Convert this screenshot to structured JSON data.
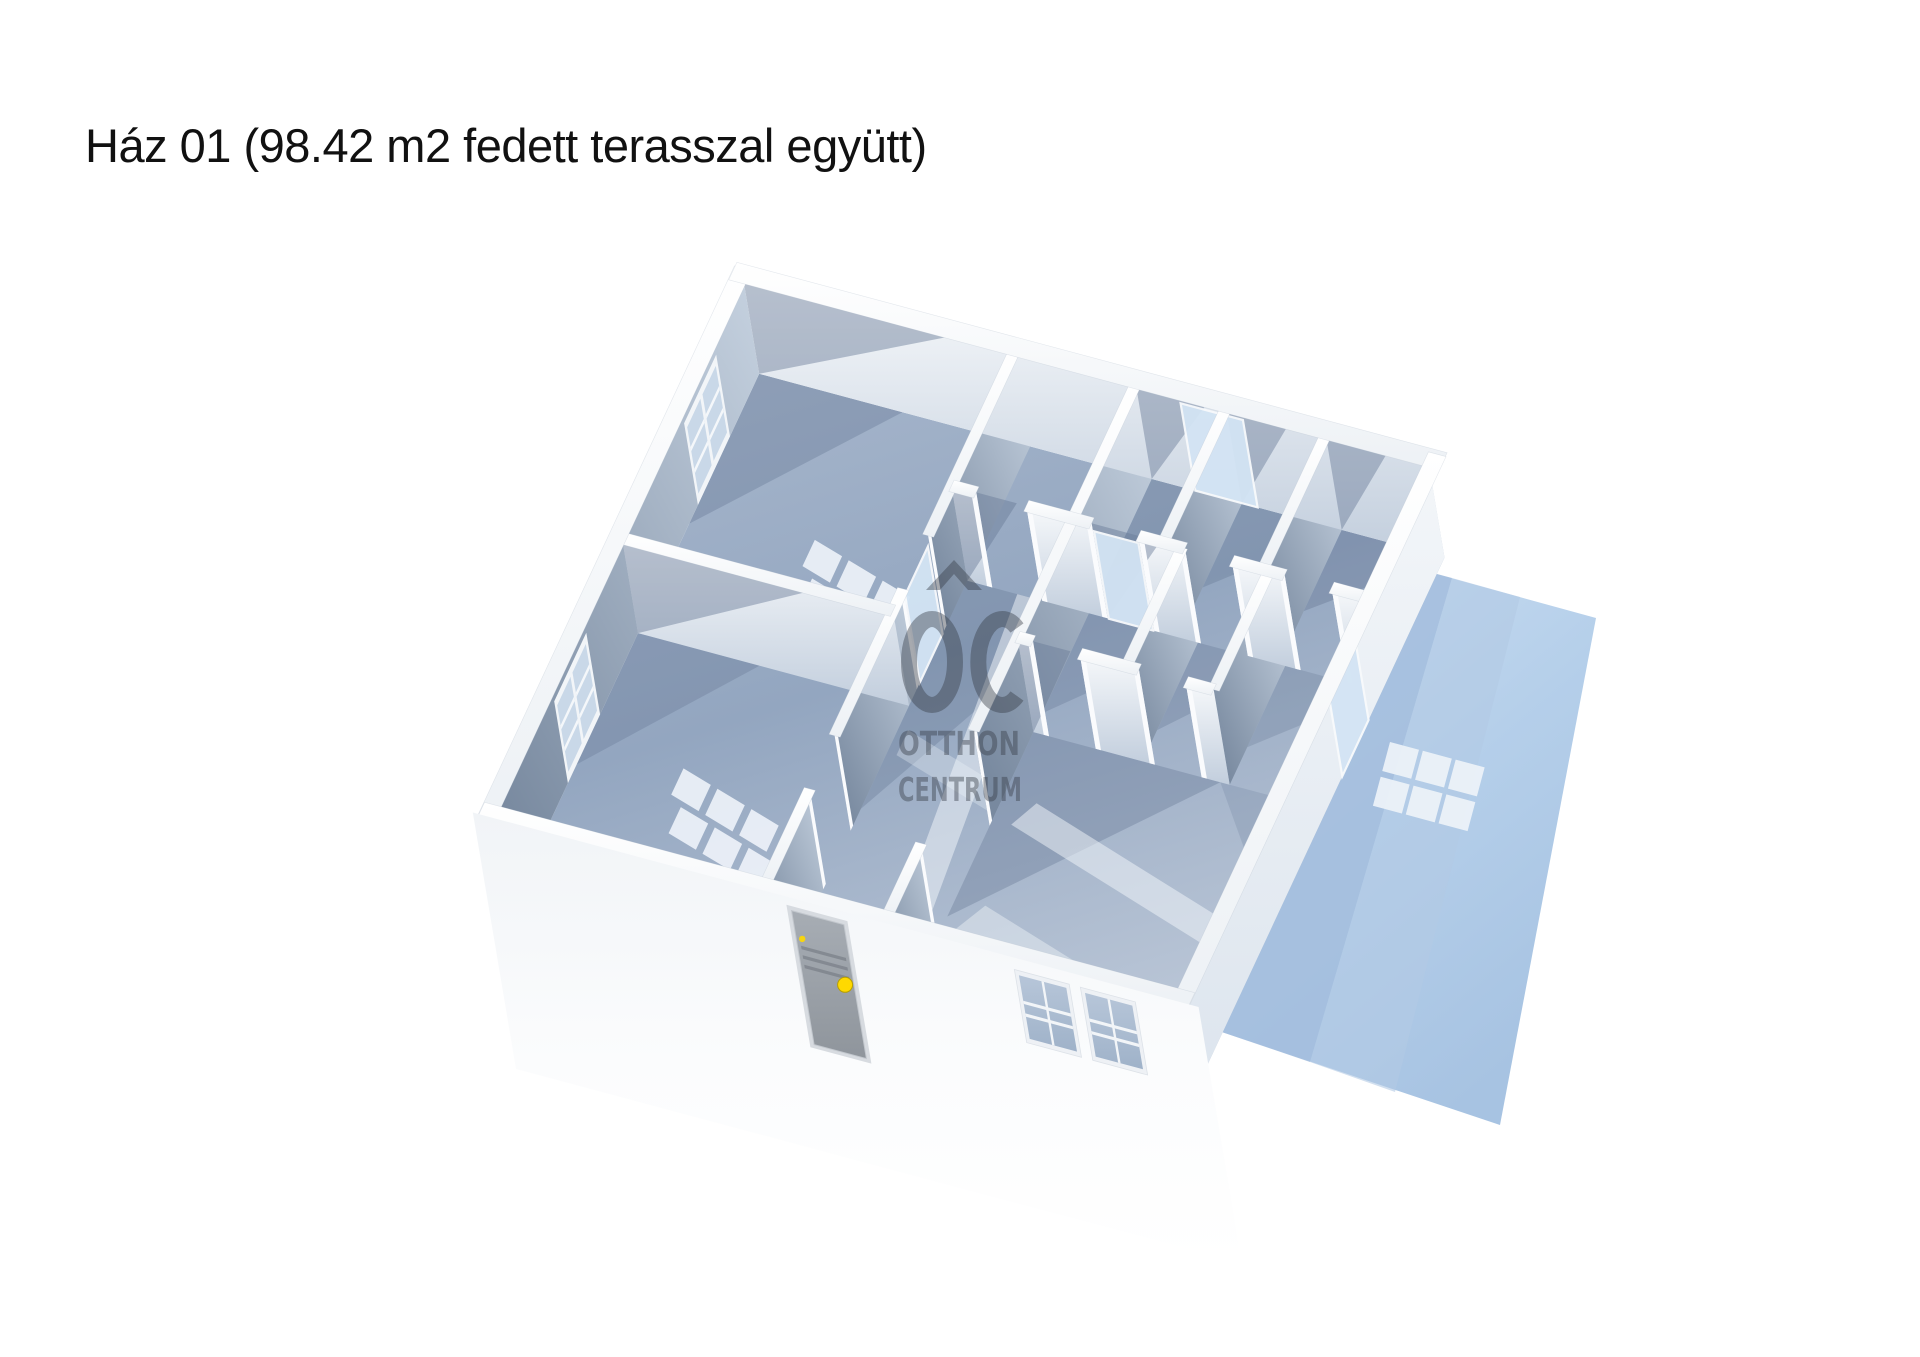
{
  "title": {
    "text": "Ház 01 (98.42 m2 fedett terasszal együtt)"
  },
  "watermark": {
    "monogram": "OC",
    "line1": "OTTHON",
    "line2": "CENTRUM"
  },
  "colors": {
    "background": "#ffffff",
    "title_text": "#111111",
    "watermark": "#363c46",
    "floor_dark": "#8da1bd",
    "floor_light": "#b9c5d6",
    "wall_top": "#fdfdfe",
    "wall_lit_top": "#f7f9fb",
    "wall_lit_bottom": "#c2cedd",
    "wall_shadow_top": "#c6d2e0",
    "wall_shadow_bottom": "#78899f",
    "terrace_light": "#cfe1f3",
    "terrace_mid": "#aac6e4",
    "terrace_shadow": "#a3bddd",
    "glass": "#c9d8e8",
    "glazed_door": "#d3e4f4",
    "door_slab": "#9aa0a8",
    "door_knob": "#ffd900",
    "light_patch": "#eef3f9"
  },
  "floorplan": {
    "origin": [
      495,
      810
    ],
    "U": [
      62.3,
      16.7
    ],
    "V": [
      29.2,
      -62.5
    ],
    "D": [
      16,
      95
    ],
    "house": {
      "w": 11,
      "d": 8.5
    },
    "walls": [
      {
        "axis": "v",
        "pos": 0,
        "from": 0,
        "to": 8.5,
        "face": "shadow"
      },
      {
        "axis": "v",
        "pos": 4.35,
        "from": 0,
        "to": 8.5,
        "face": "shadow",
        "gaps": [
          [
            1.5,
            2.35
          ],
          [
            4.7,
            5.55
          ]
        ],
        "frame": true,
        "strip": 0.09
      },
      {
        "axis": "v",
        "pos": 6.3,
        "from": 0,
        "to": 8.5,
        "face": "shadow",
        "gaps": [
          [
            1.15,
            2.95
          ]
        ],
        "frame": true,
        "strip": 0.09
      },
      {
        "axis": "v",
        "pos": 7.75,
        "from": 6.35,
        "to": 8.5,
        "face": "shadow",
        "strip": 0.09
      },
      {
        "axis": "v",
        "pos": 9.35,
        "from": 6.35,
        "to": 8.5,
        "face": "shadow",
        "strip": 0.09
      },
      {
        "axis": "v",
        "pos": 8.05,
        "from": 4.45,
        "to": 6.35,
        "face": "shadow",
        "strip": 0.09
      },
      {
        "axis": "v",
        "pos": 9.45,
        "from": 4.45,
        "to": 6.35,
        "face": "shadow",
        "strip": 0.09
      },
      {
        "axis": "u",
        "pos": 4.35,
        "from": 0,
        "to": 4.35,
        "face": "lit",
        "strip": 0.09
      },
      {
        "axis": "u",
        "pos": 6.35,
        "from": 4.35,
        "to": 11,
        "face": "lit",
        "gaps": [
          [
            4.75,
            5.55
          ],
          [
            6.6,
            7.35
          ],
          [
            8.1,
            8.85
          ],
          [
            9.7,
            10.45
          ]
        ],
        "frame": true,
        "strip": 0.09
      },
      {
        "axis": "u",
        "pos": 4.45,
        "from": 6.3,
        "to": 9.45,
        "face": "lit",
        "gaps": [
          [
            6.55,
            7.3
          ],
          [
            8.25,
            9.0
          ]
        ],
        "frame": true,
        "strip": 0.09
      },
      {
        "axis": "u",
        "pos": 8.5,
        "from": 0,
        "to": 11,
        "face": "lit"
      },
      {
        "axis": "v",
        "pos": 11,
        "from": 0,
        "to": 8.5,
        "face": "outer"
      }
    ],
    "perimeter": [
      {
        "axis": "v",
        "pos": -0.07,
        "from": -0.2,
        "to": 8.65,
        "t": 0.14
      },
      {
        "axis": "u",
        "pos": 8.57,
        "from": -0.2,
        "to": 11.2,
        "t": 0.14
      },
      {
        "axis": "v",
        "pos": 11.07,
        "from": -0.2,
        "to": 8.65,
        "t": 0.14
      },
      {
        "axis": "u",
        "pos": -0.07,
        "from": -0.2,
        "to": 11.2,
        "t": 0.14
      }
    ],
    "diag_shadows": [
      {
        "axis": "u",
        "pos": 8.5,
        "a": 0,
        "b": 3.4
      },
      {
        "axis": "u",
        "pos": 4.35,
        "a": 0,
        "b": 3.1
      },
      {
        "axis": "u",
        "pos": 6.35,
        "a": 4.35,
        "b": 5.4
      },
      {
        "axis": "u",
        "pos": 6.35,
        "a": 6.6,
        "b": 7.7
      },
      {
        "axis": "u",
        "pos": 8.5,
        "a": 6.3,
        "b": 7.45
      },
      {
        "axis": "u",
        "pos": 8.5,
        "a": 7.75,
        "b": 8.75
      },
      {
        "axis": "u",
        "pos": 8.5,
        "a": 9.35,
        "b": 10.35
      },
      {
        "axis": "u",
        "pos": 4.45,
        "a": 6.3,
        "b": 7.15
      }
    ],
    "floor_shadows": [
      {
        "pts": [
          [
            0,
            8.5
          ],
          [
            2.3,
            8.5
          ],
          [
            0,
            6.1
          ]
        ],
        "o": 0.34
      },
      {
        "pts": [
          [
            0,
            4.35
          ],
          [
            1.95,
            4.35
          ],
          [
            0,
            2.25
          ]
        ],
        "o": 0.3
      },
      {
        "pts": [
          [
            4.35,
            6.35
          ],
          [
            6.3,
            6.35
          ],
          [
            4.35,
            2.7
          ]
        ],
        "o": 0.32
      },
      {
        "pts": [
          [
            6.3,
            8.5
          ],
          [
            7.75,
            8.5
          ],
          [
            6.3,
            7.05
          ]
        ],
        "o": 0.32
      },
      {
        "pts": [
          [
            7.75,
            8.5
          ],
          [
            9.35,
            8.5
          ],
          [
            7.75,
            7.15
          ]
        ],
        "o": 0.32
      },
      {
        "pts": [
          [
            9.35,
            8.5
          ],
          [
            11,
            8.5
          ],
          [
            9.35,
            7.2
          ]
        ],
        "o": 0.36
      },
      {
        "pts": [
          [
            6.3,
            6.35
          ],
          [
            8.05,
            6.35
          ],
          [
            6.3,
            4.75
          ]
        ],
        "o": 0.3
      },
      {
        "pts": [
          [
            8.05,
            6.35
          ],
          [
            9.45,
            6.35
          ],
          [
            8.05,
            4.95
          ]
        ],
        "o": 0.3
      },
      {
        "pts": [
          [
            9.45,
            6.35
          ],
          [
            11,
            6.35
          ],
          [
            9.45,
            5.05
          ]
        ],
        "o": 0.26
      },
      {
        "pts": [
          [
            6.3,
            4.45
          ],
          [
            9.3,
            4.45
          ],
          [
            6.3,
            1.5
          ]
        ],
        "o": 0.34
      },
      {
        "pts": [
          [
            9.3,
            4.45
          ],
          [
            11,
            4.45
          ],
          [
            11,
            2.6
          ]
        ],
        "o": 0.2
      }
    ],
    "light_bands": [
      {
        "pts": [
          [
            5.15,
            6.35
          ],
          [
            5.62,
            6.35
          ],
          [
            6.15,
            0.35
          ],
          [
            5.68,
            0.35
          ]
        ],
        "o": 0.5
      },
      {
        "pts": [
          [
            6.6,
            3.05
          ],
          [
            10.6,
            1.95
          ],
          [
            10.82,
            2.35
          ],
          [
            6.82,
            3.45
          ]
        ],
        "o": 0.5
      },
      {
        "pts": [
          [
            6.5,
            1.35
          ],
          [
            10.15,
            0.35
          ],
          [
            10.42,
            0.8
          ],
          [
            6.77,
            1.8
          ]
        ],
        "o": 0.42
      },
      {
        "pts": [
          [
            4.5,
            3.6
          ],
          [
            6.2,
            3.15
          ],
          [
            6.2,
            3.55
          ],
          [
            4.5,
            4.0
          ]
        ],
        "o": 0.3
      }
    ],
    "floor_patches": [
      {
        "c": [
          1.9,
          6.35
        ]
      },
      {
        "c": [
          1.55,
          2.6
        ]
      }
    ],
    "left_windows": [
      {
        "v0": 6.4,
        "v1": 7.5
      },
      {
        "v0": 1.95,
        "v1": 3.05
      }
    ],
    "glazed_doors": [
      {
        "axis": "u",
        "pos": 6.35,
        "a": 6.62,
        "b": 7.33
      },
      {
        "axis": "u",
        "pos": 8.5,
        "a": 7.0,
        "b": 8.0
      },
      {
        "axis": "v",
        "pos": 4.35,
        "a": 4.72,
        "b": 5.5
      },
      {
        "axis": "v",
        "pos": 11,
        "a": 5.0,
        "b": 5.9
      }
    ],
    "front_door": {
      "u0": 4.78,
      "u1": 5.62,
      "h0": 0.14,
      "h1": 1.55,
      "knob": [
        5.47,
        0.8
      ]
    },
    "front_windows": [
      {
        "u0": 8.42,
        "u1": 9.18,
        "h0": 0.18,
        "h1": 0.85
      },
      {
        "u0": 9.48,
        "u1": 10.24,
        "h0": 0.18,
        "h1": 0.85
      }
    ],
    "terrace": {
      "poly": [
        [
          1396,
          563
        ],
        [
          1596,
          618
        ],
        [
          1500,
          1125
        ],
        [
          1198,
          1024
        ]
      ],
      "shadow": [
        [
          1396,
          563
        ],
        [
          1452,
          578
        ],
        [
          1310,
          1062
        ],
        [
          1198,
          1024
        ]
      ],
      "shadow2": [
        [
          1452,
          578
        ],
        [
          1520,
          597
        ],
        [
          1395,
          1092
        ],
        [
          1310,
          1062
        ]
      ],
      "patch": {
        "x": 1390,
        "y": 742,
        "rot": 15,
        "cell": 30,
        "gap": 4,
        "cols": 3,
        "rows": 2
      }
    },
    "watermark_pos": {
      "x": 958,
      "y": 660
    }
  }
}
